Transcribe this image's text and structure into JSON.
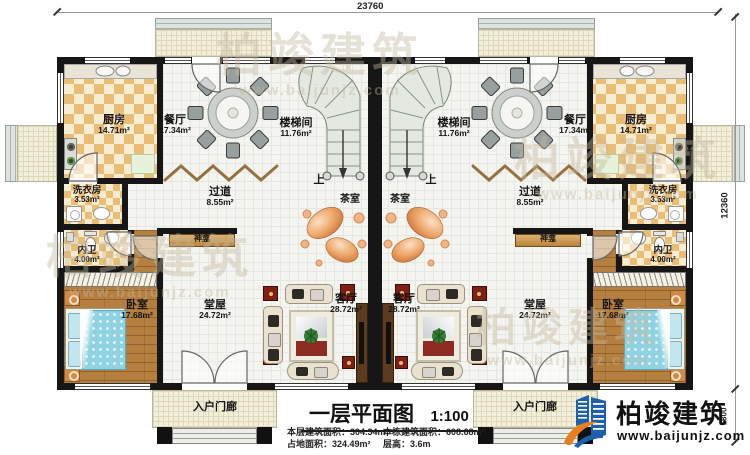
{
  "dimensions": {
    "top": "23760",
    "right": "12360",
    "porch_depth": "1800"
  },
  "rooms": {
    "kitchen": {
      "name": "厨房",
      "area": "14.71m²"
    },
    "dining": {
      "name": "餐厅",
      "area": "17.34m²"
    },
    "stairwell": {
      "name": "楼梯间",
      "area": "11.76m²"
    },
    "laundry": {
      "name": "洗衣房",
      "area": "3.53m²"
    },
    "corridor": {
      "name": "过道",
      "area": "8.55m²"
    },
    "bathroom": {
      "name": "内卫",
      "area": "4.00m²"
    },
    "bedroom": {
      "name": "卧室",
      "area": "17.68m²"
    },
    "hall": {
      "name": "堂屋",
      "area": "24.72m²"
    },
    "living": {
      "name": "客厅",
      "area": "28.72m²"
    },
    "tearoom": {
      "name": "茶室"
    },
    "shrine": {
      "name": "神龛"
    },
    "porch": {
      "name": "入户门廊"
    },
    "stairs_up": {
      "label": "上"
    }
  },
  "title_block": {
    "title": "一层平面图",
    "scale": "1:100",
    "stats": [
      {
        "label": "本层建筑面积：",
        "value": "304.34m²"
      },
      {
        "label": "本栋建筑面积：",
        "value": "608.68m²"
      },
      {
        "label": "占地面积：",
        "value": "324.49m²"
      },
      {
        "label": "层高：",
        "value": "3.6m"
      }
    ]
  },
  "logo": {
    "company": "柏竣建筑",
    "website": "www.baijunjz.com"
  },
  "watermark": {
    "text": "柏竣建筑",
    "subtext": "www.baijunjz.com"
  },
  "colors": {
    "wall": "#161616",
    "checker": "#eabd74",
    "wood": "#b5803f",
    "bed": "#8fd3e2",
    "logo_blue": "#1e5fae",
    "logo_orange": "#e87f1e"
  }
}
